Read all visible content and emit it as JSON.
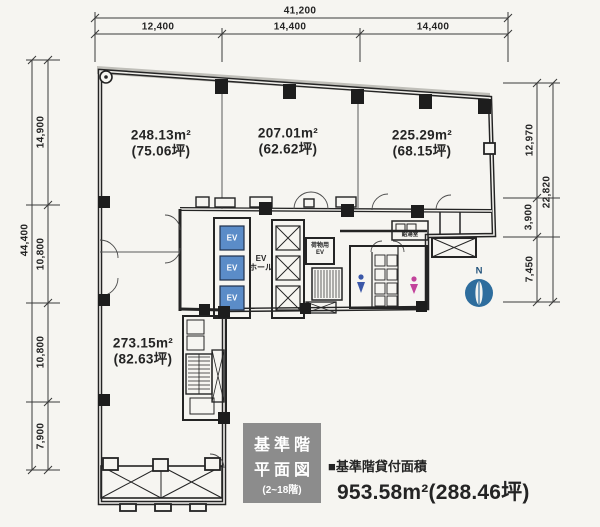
{
  "palette": {
    "paper": "#f6f5f1",
    "ink": "#242424",
    "elevator_blue": "#5b8cc8",
    "mens_icon_blue": "#3a57a8",
    "womens_icon_pink": "#c2439b",
    "compass_blue": "#2e6d9d",
    "title_box_gray": "#8c8c8c"
  },
  "dimensions": {
    "top": {
      "total": "41,200",
      "segments": [
        "12,400",
        "14,400",
        "14,400"
      ]
    },
    "left": {
      "total": "44,400",
      "segments": [
        "14,900",
        "10,800",
        "10,800",
        "7,900"
      ]
    },
    "right": {
      "outer": "22,820",
      "segments": [
        "12,970",
        "3,900",
        "7,450"
      ]
    }
  },
  "areas": [
    {
      "sqm": "248.13m²",
      "tsubo": "(75.06坪)"
    },
    {
      "sqm": "207.01m²",
      "tsubo": "(62.62坪)"
    },
    {
      "sqm": "225.29m²",
      "tsubo": "(68.15坪)"
    },
    {
      "sqm": "273.15m²",
      "tsubo": "(82.63坪)"
    }
  ],
  "core": {
    "ev_car": "EV",
    "ev_hall_line1": "EV",
    "ev_hall_line2": "ホール",
    "cargo_ev_line1": "荷物用",
    "cargo_ev_line2": "EV",
    "kitchenette": "給湯室"
  },
  "compass": {
    "north": "N"
  },
  "title_block": {
    "line1": "基準階",
    "line2": "平面図",
    "line3": "(2~18階)"
  },
  "summary": {
    "label": "■基準階貸付面積",
    "value": "953.58m²(288.46坪)"
  }
}
